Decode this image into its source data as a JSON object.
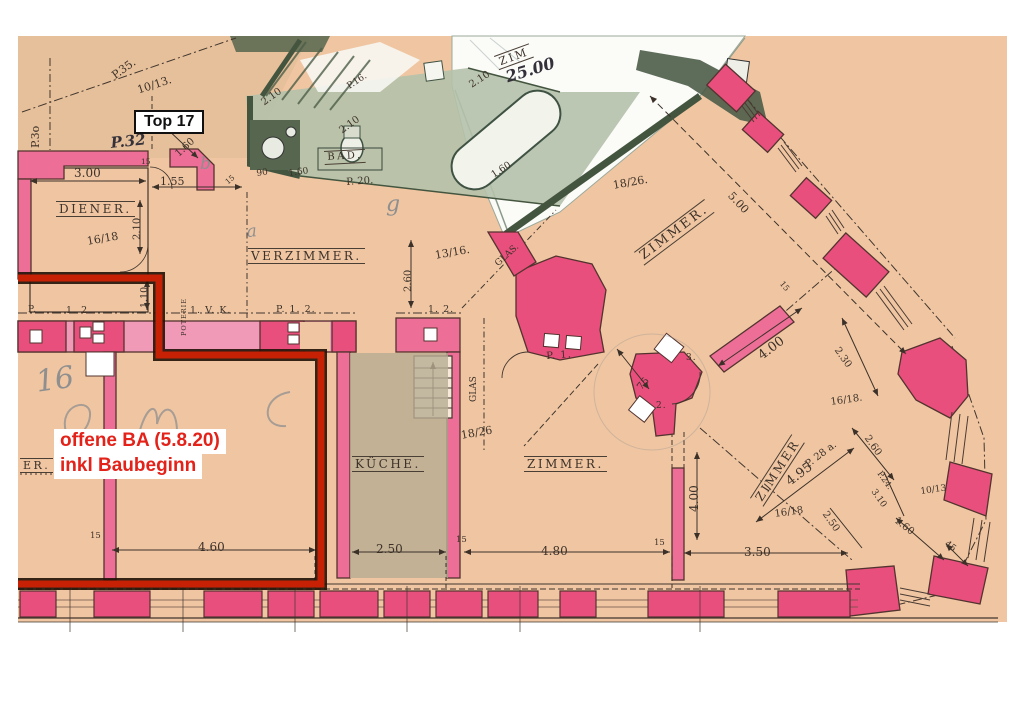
{
  "badge": {
    "label": "Top 17"
  },
  "note": {
    "line1": "offene BA (5.8.20)",
    "line2": "inkl Baubeginn"
  },
  "colors": {
    "paper_white": "#ffffff",
    "plan_tan": "#f0c6a2",
    "plan_tan_dark": "#e6c09a",
    "wall_pink": "#ed6e96",
    "pier_pink": "#e84f7c",
    "band_pink": "#f19ab8",
    "green_dark": "#435447",
    "green_wash": "#b4c1aa",
    "sheet_white": "#fbfbf8",
    "ink": "#3c3129",
    "red_line": "#c62104",
    "red_text": "#e3221a",
    "pencil": "#8f8f8f"
  },
  "labels": [
    {
      "n": "room-label-diener",
      "t": "DIENER.",
      "x": 56,
      "y": 201,
      "r": 0,
      "s": 12,
      "c": "room"
    },
    {
      "n": "room-label-verzimmer",
      "t": "VERZIMMER.",
      "x": 248,
      "y": 248,
      "r": 0,
      "s": 12,
      "c": "room"
    },
    {
      "n": "room-label-zimmer-ne",
      "t": "ZIMMER.",
      "x": 634,
      "y": 252,
      "r": -37,
      "s": 13,
      "c": "room"
    },
    {
      "n": "room-label-zimmer-s",
      "t": "ZIMMER.",
      "x": 524,
      "y": 456,
      "r": 0,
      "s": 12,
      "c": "room"
    },
    {
      "n": "room-label-kueche",
      "t": "KÜCHE.",
      "x": 352,
      "y": 456,
      "r": 0,
      "s": 12,
      "c": "room"
    },
    {
      "n": "room-label-zimmer-e",
      "t": "ZIMMER",
      "x": 750,
      "y": 498,
      "r": -57,
      "s": 12,
      "c": "room"
    },
    {
      "n": "room-label-fragment",
      "t": "ER.",
      "x": 20,
      "y": 458,
      "r": 0,
      "s": 11,
      "c": "room"
    },
    {
      "n": "room-label-zim-sheet",
      "t": "ZIM",
      "x": 494,
      "y": 56,
      "r": -20,
      "s": 11,
      "c": "room"
    },
    {
      "n": "room-label-bad",
      "t": "BAD.",
      "x": 324,
      "y": 151,
      "r": -3,
      "s": 10,
      "c": "room"
    },
    {
      "n": "glas-label-diag",
      "t": "GLAS.",
      "x": 494,
      "y": 262,
      "r": -42,
      "s": 9,
      "c": "dim"
    },
    {
      "n": "glas-label-vert",
      "t": "GLAS",
      "x": 470,
      "y": 402,
      "r": -90,
      "s": 9,
      "c": "dim"
    },
    {
      "n": "poterie-label",
      "t": "POTERIE",
      "x": 181,
      "y": 336,
      "r": -90,
      "s": 6.5,
      "c": "tag"
    },
    {
      "n": "dim-p35",
      "t": "P.35.",
      "x": 110,
      "y": 72,
      "r": -36,
      "s": 11,
      "c": "dim"
    },
    {
      "n": "dim-p30",
      "t": "P.3o",
      "x": 30,
      "y": 148,
      "r": -90,
      "s": 11,
      "c": "dim"
    },
    {
      "n": "frac-10-13-top",
      "t": "10/13.",
      "x": 136,
      "y": 85,
      "r": -18,
      "s": 11,
      "c": "dim"
    },
    {
      "n": "hand-p32",
      "t": "P.32",
      "x": 110,
      "y": 136,
      "r": -6,
      "s": 15,
      "c": "hand"
    },
    {
      "n": "dim-gls",
      "t": "Gls.",
      "x": 176,
      "y": 130,
      "r": -35,
      "s": 8,
      "c": "dim"
    },
    {
      "n": "dim-160-tl",
      "t": "1.60",
      "x": 174,
      "y": 152,
      "r": -43,
      "s": 10,
      "c": "dim"
    },
    {
      "n": "dim-300",
      "t": "3.00",
      "x": 74,
      "y": 167,
      "r": 0,
      "s": 12,
      "c": "dim"
    },
    {
      "n": "dim-155",
      "t": "1.55",
      "x": 160,
      "y": 176,
      "r": 0,
      "s": 11,
      "c": "dim"
    },
    {
      "n": "dim-15-a",
      "t": "15",
      "x": 141,
      "y": 158,
      "r": 0,
      "s": 7.5,
      "c": "dim"
    },
    {
      "n": "dim-15-b",
      "t": "15",
      "x": 224,
      "y": 180,
      "r": -40,
      "s": 7.5,
      "c": "dim"
    },
    {
      "n": "dim-210-v",
      "t": "2.10",
      "x": 133,
      "y": 240,
      "r": -90,
      "s": 10,
      "c": "dim"
    },
    {
      "n": "frac-16-18-diener",
      "t": "16/18",
      "x": 86,
      "y": 236,
      "r": -10,
      "s": 11,
      "c": "dim"
    },
    {
      "n": "dim-110-v",
      "t": "1.10",
      "x": 140,
      "y": 308,
      "r": -90,
      "s": 9.5,
      "c": "dim"
    },
    {
      "n": "dim-210-g1",
      "t": "2.10",
      "x": 260,
      "y": 100,
      "r": -36,
      "s": 10,
      "c": "dim"
    },
    {
      "n": "dim-210-g2",
      "t": "2.10",
      "x": 338,
      "y": 128,
      "r": -36,
      "s": 10,
      "c": "dim"
    },
    {
      "n": "dim-p16",
      "t": "P.16.",
      "x": 346,
      "y": 84,
      "r": -33,
      "s": 9,
      "c": "dim"
    },
    {
      "n": "dim-90-g",
      "t": "90",
      "x": 256,
      "y": 170,
      "r": -8,
      "s": 9,
      "c": "dim"
    },
    {
      "n": "dim-160-g",
      "t": "1.60",
      "x": 288,
      "y": 170,
      "r": -8,
      "s": 9,
      "c": "dim"
    },
    {
      "n": "dim-p20",
      "t": "P. 20.",
      "x": 346,
      "y": 178,
      "r": -4,
      "s": 10,
      "c": "dim"
    },
    {
      "n": "dim-210-sheet",
      "t": "2.10",
      "x": 468,
      "y": 82,
      "r": -33,
      "s": 10,
      "c": "dim"
    },
    {
      "n": "dim-160-sheet",
      "t": "1.60",
      "x": 490,
      "y": 172,
      "r": -33,
      "s": 9.5,
      "c": "dim"
    },
    {
      "n": "frac-18-26-top",
      "t": "18/26.",
      "x": 612,
      "y": 180,
      "r": -10,
      "s": 11,
      "c": "dim"
    },
    {
      "n": "dim-500-diag",
      "t": "5.00",
      "x": 734,
      "y": 190,
      "r": 47,
      "s": 11,
      "c": "dim"
    },
    {
      "n": "frac-13-16",
      "t": "13/16.",
      "x": 434,
      "y": 250,
      "r": -10,
      "s": 11,
      "c": "dim"
    },
    {
      "n": "dim-260-v",
      "t": "2.60",
      "x": 404,
      "y": 292,
      "r": -90,
      "s": 10,
      "c": "dim"
    },
    {
      "n": "dim-75",
      "t": "75",
      "x": 636,
      "y": 386,
      "r": -50,
      "s": 10,
      "c": "dim"
    },
    {
      "n": "tag-p1",
      "t": "P. 1.",
      "x": 546,
      "y": 352,
      "r": -4,
      "s": 10,
      "c": "tag"
    },
    {
      "n": "tag-3",
      "t": "3.",
      "x": 686,
      "y": 354,
      "r": 0,
      "s": 9,
      "c": "tag"
    },
    {
      "n": "tag-2",
      "t": "2.",
      "x": 656,
      "y": 402,
      "r": 0,
      "s": 9,
      "c": "tag"
    },
    {
      "n": "dim-400-diag",
      "t": "4.00",
      "x": 756,
      "y": 352,
      "r": -37,
      "s": 13,
      "c": "dim"
    },
    {
      "n": "dim-230-diag",
      "t": "2.30",
      "x": 840,
      "y": 346,
      "r": 55,
      "s": 10,
      "c": "dim"
    },
    {
      "n": "frac-16-18-e",
      "t": "16/18.",
      "x": 830,
      "y": 398,
      "r": -8,
      "s": 10,
      "c": "dim"
    },
    {
      "n": "dim-p28a",
      "t": "P. 28 a.",
      "x": 804,
      "y": 462,
      "r": -37,
      "s": 10,
      "c": "dim"
    },
    {
      "n": "dim-495",
      "t": "4.95",
      "x": 784,
      "y": 478,
      "r": -37,
      "s": 13,
      "c": "dim"
    },
    {
      "n": "dim-260-bay",
      "t": "2.60",
      "x": 870,
      "y": 434,
      "r": 55,
      "s": 10,
      "c": "dim"
    },
    {
      "n": "dim-p24",
      "t": "P.24.",
      "x": 882,
      "y": 470,
      "r": 55,
      "s": 8.5,
      "c": "dim"
    },
    {
      "n": "dim-310",
      "t": "3.10",
      "x": 876,
      "y": 488,
      "r": 55,
      "s": 9,
      "c": "dim"
    },
    {
      "n": "frac-10-13-bay",
      "t": "10/13",
      "x": 920,
      "y": 488,
      "r": -8,
      "s": 9,
      "c": "dim"
    },
    {
      "n": "dim-160-bay",
      "t": "1.60",
      "x": 898,
      "y": 516,
      "r": 38,
      "s": 10,
      "c": "dim"
    },
    {
      "n": "dim-45-bay",
      "t": "45",
      "x": 948,
      "y": 540,
      "r": 38,
      "s": 9,
      "c": "dim"
    },
    {
      "n": "dim-250-bay",
      "t": "2.50",
      "x": 828,
      "y": 510,
      "r": 55,
      "s": 10,
      "c": "dim"
    },
    {
      "n": "frac-16-18-s",
      "t": "16/18",
      "x": 774,
      "y": 510,
      "r": -8,
      "s": 10,
      "c": "dim"
    },
    {
      "n": "dim-400-v",
      "t": "4.00",
      "x": 688,
      "y": 512,
      "r": -90,
      "s": 12,
      "c": "dim"
    },
    {
      "n": "dim-350",
      "t": "3.50",
      "x": 744,
      "y": 546,
      "r": 0,
      "s": 12,
      "c": "dim"
    },
    {
      "n": "dim-15-c",
      "t": "15",
      "x": 654,
      "y": 539,
      "r": 0,
      "s": 8.5,
      "c": "dim"
    },
    {
      "n": "dim-480",
      "t": "4.80",
      "x": 541,
      "y": 545,
      "r": 0,
      "s": 12,
      "c": "dim"
    },
    {
      "n": "dim-15-d",
      "t": "15",
      "x": 456,
      "y": 536,
      "r": 0,
      "s": 8.5,
      "c": "dim"
    },
    {
      "n": "dim-250-k",
      "t": "2.50",
      "x": 376,
      "y": 543,
      "r": 0,
      "s": 12,
      "c": "dim"
    },
    {
      "n": "dim-460",
      "t": "4.60",
      "x": 198,
      "y": 541,
      "r": 0,
      "s": 12,
      "c": "dim"
    },
    {
      "n": "dim-15-e",
      "t": "15",
      "x": 90,
      "y": 532,
      "r": 0,
      "s": 8.5,
      "c": "dim"
    },
    {
      "n": "frac-18-26-k",
      "t": "18/26",
      "x": 460,
      "y": 430,
      "r": -10,
      "s": 11,
      "c": "dim"
    },
    {
      "n": "tag-p",
      "t": "P.",
      "x": 28,
      "y": 306,
      "r": 0,
      "s": 9,
      "c": "tag"
    },
    {
      "n": "tag-12-a",
      "t": "1. 2.",
      "x": 66,
      "y": 306,
      "r": 0,
      "s": 9.5,
      "c": "tag"
    },
    {
      "n": "tag-1vk",
      "t": "1. V. K.",
      "x": 190,
      "y": 306,
      "r": 0,
      "s": 9.5,
      "c": "tag"
    },
    {
      "n": "tag-p12",
      "t": "P. 1. 2.",
      "x": 276,
      "y": 305,
      "r": 0,
      "s": 9.5,
      "c": "tag"
    },
    {
      "n": "tag-12-b",
      "t": "1. 2.",
      "x": 428,
      "y": 305,
      "r": 0,
      "s": 9.5,
      "c": "tag"
    },
    {
      "n": "dim-15-wall",
      "t": "15",
      "x": 784,
      "y": 280,
      "r": 50,
      "s": 8,
      "c": "dim"
    },
    {
      "n": "hand-2500",
      "t": "25.00",
      "x": 504,
      "y": 70,
      "r": -17,
      "s": 16,
      "c": "hand"
    },
    {
      "n": "pencil-16",
      "t": "16",
      "x": 34,
      "y": 368,
      "r": -8,
      "s": 30,
      "c": "pencil"
    },
    {
      "n": "pencil-a",
      "t": "a",
      "x": 246,
      "y": 224,
      "r": -5,
      "s": 17,
      "c": "pencil"
    },
    {
      "n": "pencil-b",
      "t": "b",
      "x": 200,
      "y": 156,
      "r": 0,
      "s": 17,
      "c": "pencil"
    },
    {
      "n": "pencil-g",
      "t": "g",
      "x": 386,
      "y": 194,
      "r": 0,
      "s": 22,
      "c": "pencil"
    }
  ]
}
